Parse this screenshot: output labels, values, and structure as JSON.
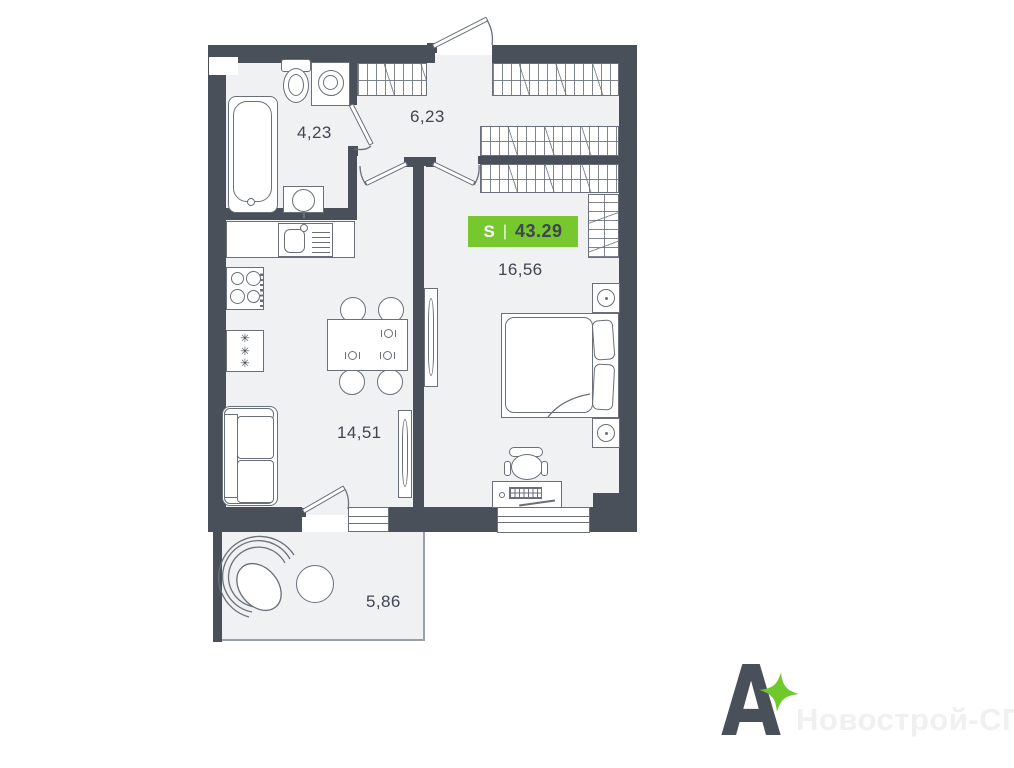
{
  "plan": {
    "badge": {
      "prefix": "S",
      "separator": "|",
      "value": "43.29",
      "bg_color": "#76C82E",
      "prefix_color": "#FFFFFF",
      "value_color": "#3E4550"
    },
    "rooms": {
      "bathroom": {
        "label": "4,23"
      },
      "hallway": {
        "label": "6,23"
      },
      "bedroom": {
        "label": "16,56"
      },
      "kitchen_living": {
        "label": "14,51"
      },
      "balcony": {
        "label": "5,86"
      }
    },
    "kitchen": {
      "fridge_symbol": "✳✳✳"
    },
    "colors": {
      "wall": "#4A505A",
      "floor": "#F0F1F3",
      "furniture_stroke": "#69707A",
      "label_text": "#3F4651",
      "accent_green": "#76C82E"
    }
  },
  "branding": {
    "logo_letter": "А",
    "logo_color": "#4A5059",
    "sparkle_color": "#6FC92C",
    "watermark_text": "Новострой-СПб",
    "watermark_color": "#F0F0F0"
  }
}
